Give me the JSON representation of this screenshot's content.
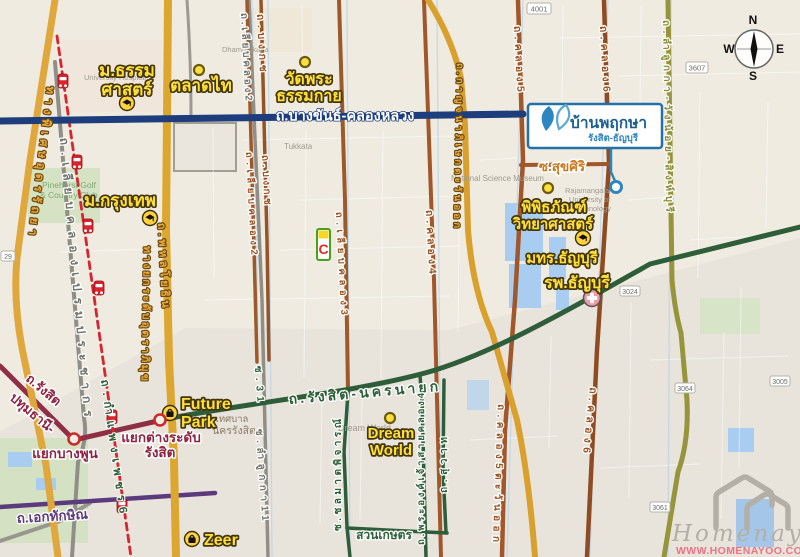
{
  "watermark": {
    "brand": "Homenayoo",
    "url": "WWW.HOMENAYOO.COM"
  },
  "compass": {
    "n": "N",
    "w": "W",
    "e": "E",
    "s": "S"
  },
  "callout": {
    "title": "บ้านพฤกษา",
    "subtitle": "รังสิต-ธัญบุรี"
  },
  "pois": {
    "thammasat_l1": "ม.ธรรม",
    "thammasat_l2": "ศาสตร์",
    "taladthai": "ตลาดไท",
    "watphra_l1": "วัดพระ",
    "watphra_l2": "ธรรมกาย",
    "bangkok_univ": "ม.กรุงเทพ",
    "future_l1": "Future",
    "future_l2": "Park",
    "zeer": "Zeer",
    "dream_l1": "Dream",
    "dream_l2": "World",
    "science_l1": "พิพิธภัณฑ์",
    "science_l2": "วิทยาศาสตร์",
    "rmutt": "มทร.ธัญบุรี",
    "thanyaburi_hospital": "รพ.ธัญบุรี"
  },
  "junctions": {
    "rangsit_l1": "แยกต่างระดับ",
    "rangsit_l2": "รังสิต",
    "bangphun": "แยกบางพูน"
  },
  "roads": {
    "bangkhan": "ถ.บางขันธ์-คลองหลวง",
    "udonratthaya": "ทางพิเศษอุดรรัถยา",
    "prem": "ถ.เลียบคลองเปรมประชากร",
    "phahonyothin": "ถ.พหลโยธิน",
    "tollway": "ทางยกระดับอุตราภิมุข",
    "rangsit_pathum_l1": "ถ.รังสิต",
    "rangsit_pathum_l2": "ปทุมธานี-",
    "ekkathaksin": "ถ.เอกทักษิณ",
    "kamphaengphet6": "ถ.กำแพงเพชร6",
    "rangsit_nakhonnayok": "ถ.รังสิต-นครนายก",
    "liab_khlong2_top": "ถ.เลียบคลอง2",
    "bongkot_top": "ถ.บงกช",
    "liab_khlong2": "ถ.เลียบคลอง2",
    "bongkot": "ถ.บงกช",
    "liab_khlong3": "ถ.เลียบคลอง3",
    "khlong4": "ถ.คลอง4",
    "khlong5": "ถ.คลอง5",
    "khlong6": "ถ.คลอง6",
    "khlong5_east": "ถ.คลอง5ตะวันออก",
    "khlong6_south": "ถ.คลอง6",
    "kanchanaphisek": "ถ.กาญจนาภิเษกตะวันออก",
    "lamlukka_wangnoi": "ถ.ลำลูกกา-วังน้อย-สิงห์บุรี",
    "soi31": "ซ.31",
    "soi_lamlukka11": "ซ.ลำลูกกา11",
    "chonlamat": "ซ.ชลมาตพิจารณ์",
    "phraong_chao": "ถ.พระองค์เจ้าสายคลอง4",
    "suwat": "ถ.สุวาท",
    "suksiri": "ซ.สุขศิริ"
  },
  "areas": {
    "suankaset": "สวนเกษตร",
    "nakhon_rangsit_l1": "เทศบาล",
    "nakhon_rangsit_l2": "นครรังสิต"
  },
  "map_texts": {
    "tukkata": "Tukkata",
    "nsm": "National Science Museum",
    "rmutt_en_l1": "Rajamangala",
    "rmutt_en_l2": "University of",
    "rmutt_en_l3": "Technology",
    "pinehurst_l1": "Pinehurst Golf",
    "pinehurst_l2": "& Country Club",
    "dreamworld_en": "Dream World",
    "univ_hospital": "University Hospital",
    "dhammakaya_en": "Dhammakaya"
  },
  "badges": {
    "b4001": "4001",
    "b3607": "3607",
    "b3024": "3024",
    "b3064": "3064",
    "b3005": "3005",
    "b3061": "3061",
    "b29": "29"
  },
  "icons": {
    "bigc_letter": "C"
  },
  "colors": {
    "accent_blue": "#2471a8",
    "road_yellow": "#dca62f",
    "road_brown": "#9c5a2a",
    "road_green": "#2e5d3a",
    "road_olive": "#96953c",
    "road_blue": "#1d3d7d",
    "road_crimson": "#8e2f45",
    "road_purple": "#5c3a7e",
    "rail_red": "#d6252e",
    "label_yellow": "#ffdf3c",
    "watermark_pink": "#ee7284"
  }
}
